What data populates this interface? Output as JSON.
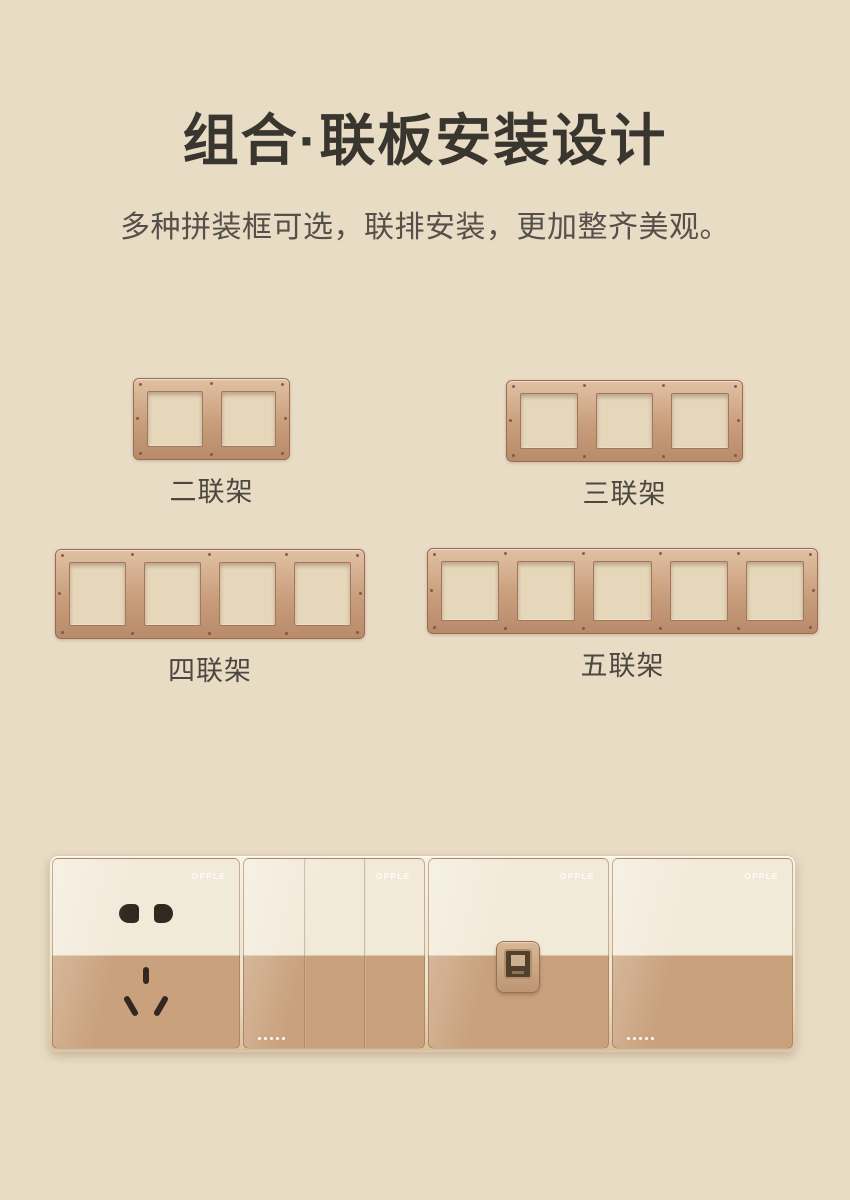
{
  "page": {
    "title": "组合·联板安装设计",
    "subtitle": "多种拼装框可选，联排安装，更加整齐美观。"
  },
  "frames": [
    {
      "label": "二联架",
      "gangs": 2
    },
    {
      "label": "三联架",
      "gangs": 3
    },
    {
      "label": "四联架",
      "gangs": 4
    },
    {
      "label": "五联架",
      "gangs": 5
    }
  ],
  "strip": {
    "modules": [
      {
        "type": "socket-5-hole",
        "brand": "OPPLE"
      },
      {
        "type": "switch-3-gang",
        "brand": "OPPLE"
      },
      {
        "type": "network-port",
        "brand": "OPPLE"
      },
      {
        "type": "switch-1-gang",
        "brand": "OPPLE"
      }
    ]
  },
  "colors": {
    "background": "#e9dcc5",
    "title": "#39362f",
    "subtitle": "#55514a",
    "label": "#4c4841",
    "frame_bronze": "#c99e7c",
    "frame_edge": "#9c6b52",
    "panel_cream": "#f2ead9",
    "panel_gold": "#c9a17c"
  }
}
